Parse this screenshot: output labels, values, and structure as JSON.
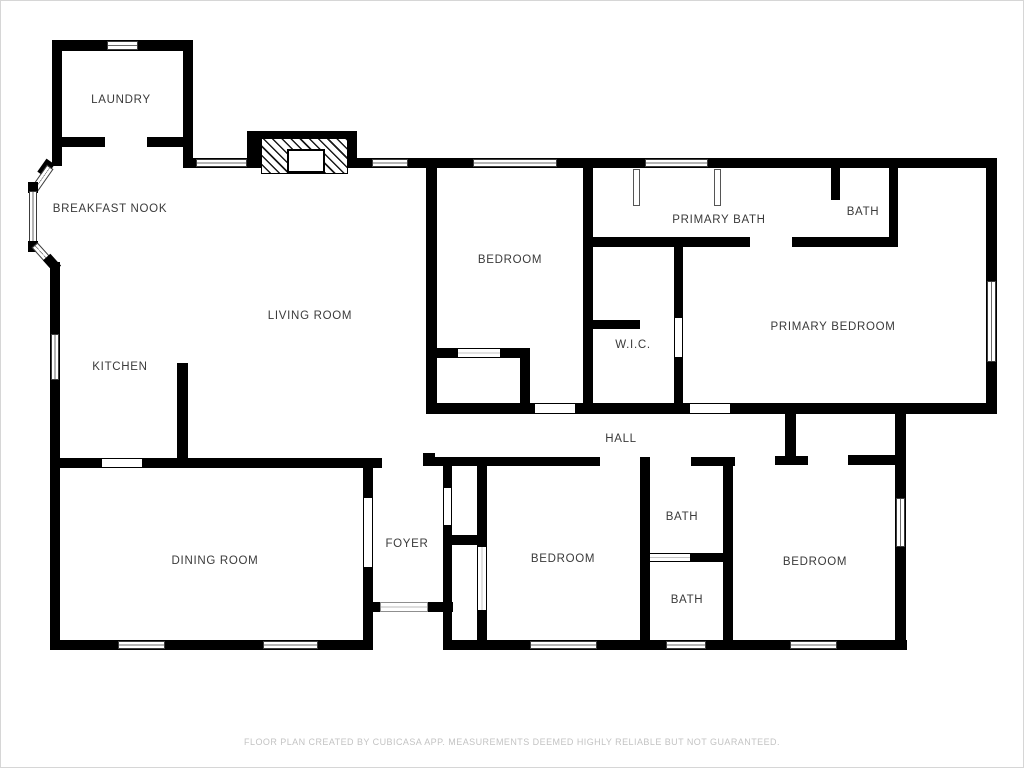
{
  "diagram": {
    "type": "floor-plan",
    "creator_note": "FLOOR PLAN CREATED BY CUBICASA APP. MEASUREMENTS DEEMED HIGHLY RELIABLE BUT NOT GUARANTEED."
  },
  "rooms": {
    "laundry": {
      "label": "LAUNDRY"
    },
    "breakfast_nook": {
      "label": "BREAKFAST NOOK"
    },
    "living_room": {
      "label": "LIVING ROOM"
    },
    "kitchen": {
      "label": "KITCHEN"
    },
    "bedroom_top": {
      "label": "BEDROOM"
    },
    "primary_bath": {
      "label": "PRIMARY BATH"
    },
    "bath_top_right": {
      "label": "BATH"
    },
    "primary_bedroom": {
      "label": "PRIMARY BEDROOM"
    },
    "wic": {
      "label": "W.I.C."
    },
    "hall": {
      "label": "HALL"
    },
    "dining_room": {
      "label": "DINING ROOM"
    },
    "foyer": {
      "label": "FOYER"
    },
    "bedroom_center": {
      "label": "BEDROOM"
    },
    "bath_mid": {
      "label": "BATH"
    },
    "bath_lower": {
      "label": "BATH"
    },
    "bedroom_right": {
      "label": "BEDROOM"
    }
  },
  "colors": {
    "wall": "#000000",
    "label_text": "#3a3a3a",
    "footer_text": "#c3c3c3",
    "background": "#ffffff"
  }
}
